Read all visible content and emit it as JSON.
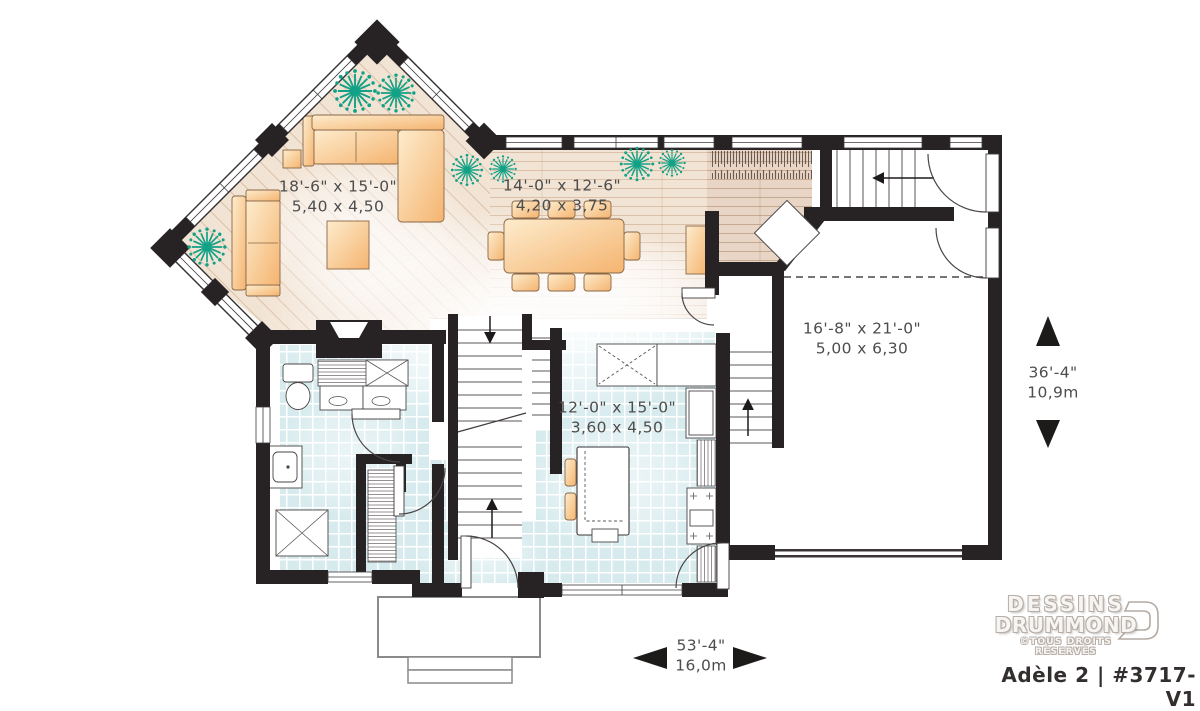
{
  "labels": {
    "living": {
      "imperial": "18'-6\" x 15'-0\"",
      "metric": "5,40 x 4,50"
    },
    "dining": {
      "imperial": "14'-0\" x 12'-6\"",
      "metric": "4,20 x 3,75"
    },
    "garage": {
      "imperial": "16'-8\" x 21'-0\"",
      "metric": "5,00 x 6,30"
    },
    "kitchen": {
      "imperial": "12'-0\" x 15'-0\"",
      "metric": "3,60 x 4,50"
    }
  },
  "dimensions": {
    "width": {
      "imperial": "53'-4\"",
      "metric": "16,0m"
    },
    "depth": {
      "imperial": "36'-4\"",
      "metric": "10,9m"
    }
  },
  "branding": {
    "brand_line1": "DESSINS",
    "brand_line2": "DRUMMOND",
    "rights": "©TOUS DROITS RÉSERVÉS",
    "plan_name": "Adèle 2",
    "separator": "|",
    "plan_number": "#3717-V1"
  },
  "colors": {
    "wall": "#272324",
    "wood_floor": "#f2e4d5",
    "foyer_floor": "#e8d5c6",
    "tile_floor": "#d7ebee",
    "furniture": "#f6b873",
    "plant": "#12a186",
    "annotation_text": "#4d4d4d"
  }
}
